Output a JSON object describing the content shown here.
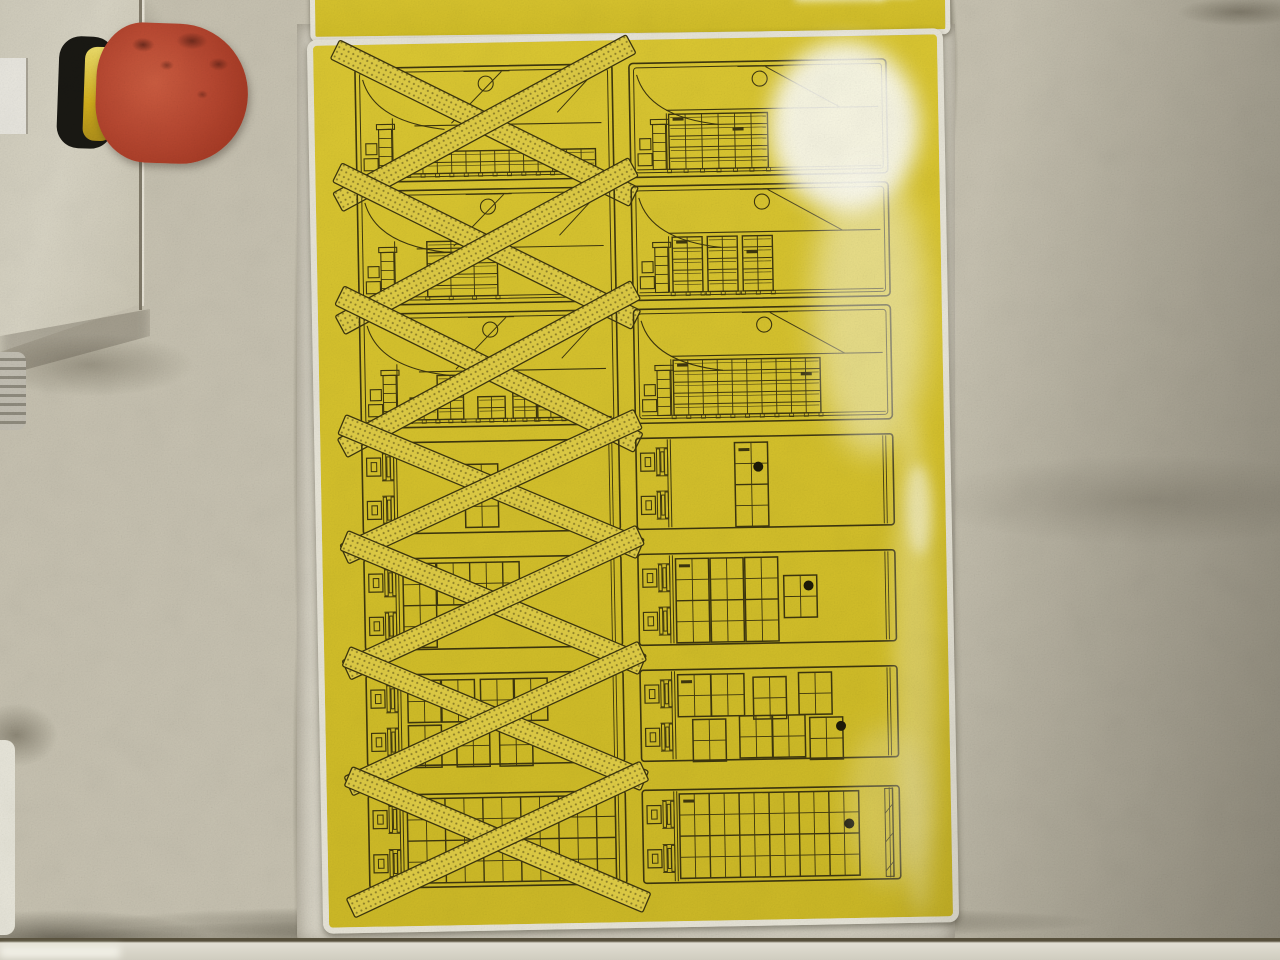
{
  "scene": {
    "description": "Dirty industrial machine panel with a red emergency-stop button and glossy yellow loading-instruction stickers showing prohibited (crossed-out) and correct tray-stack configurations",
    "background_color": "#c7c2b1",
    "plate_color": "#d8d4c6"
  },
  "estop": {
    "name": "emergency-stop-button",
    "head_color": "#b84831",
    "collar_color": "#d2ae1c",
    "base_color": "#191813"
  },
  "top_sticker": {
    "color": "#d6c22e",
    "border_color": "#eae7db"
  },
  "main_sticker": {
    "color": "#d6c22e",
    "border_color": "#e8e5d8",
    "line_color": "#3d360e",
    "cross_band_color": "#e0cd45",
    "rows": [
      {
        "left": {
          "view": "side",
          "crossed": true,
          "stacks": [
            {
              "x": 0.205,
              "w": 0.72,
              "cols": 13,
              "layers": 2
            }
          ],
          "dashes": []
        },
        "right": {
          "view": "side",
          "crossed": false,
          "stacks": [
            {
              "x": 0.155,
              "w": 0.38,
              "cols": 6,
              "layers": 5
            }
          ],
          "dashes": [
            {
              "x": 0.17,
              "layer": 5
            },
            {
              "x": 0.4,
              "layer": 4
            }
          ]
        }
      },
      {
        "left": {
          "view": "side",
          "crossed": true,
          "stacks": [
            {
              "x": 0.27,
              "w": 0.27,
              "cols": 3,
              "layers": 4
            },
            {
              "x": 0.27,
              "w": 0.185,
              "cols": 2,
              "layers": 1,
              "start": 4
            }
          ],
          "dashes": []
        },
        "right": {
          "view": "side",
          "crossed": false,
          "stacks": [
            {
              "x": 0.16,
              "w": 0.115,
              "cols": 2,
              "layers": 5
            },
            {
              "x": 0.295,
              "w": 0.115,
              "cols": 2,
              "layers": 5
            },
            {
              "x": 0.43,
              "w": 0.115,
              "cols": 2,
              "layers": 5
            }
          ],
          "dashes": [
            {
              "x": 0.175,
              "layer": 5
            },
            {
              "x": 0.445,
              "layer": 4
            }
          ]
        }
      },
      {
        "left": {
          "view": "side",
          "crossed": true,
          "stacks": [
            {
              "x": 0.195,
              "w": 0.105,
              "cols": 2,
              "layers": 2
            },
            {
              "x": 0.3,
              "w": 0.1,
              "cols": 2,
              "layers": 4
            },
            {
              "x": 0.455,
              "w": 0.105,
              "cols": 2,
              "layers": 2
            },
            {
              "x": 0.59,
              "w": 0.09,
              "cols": 2,
              "layers": 3
            },
            {
              "x": 0.685,
              "w": 0.1,
              "cols": 2,
              "layers": 2
            }
          ],
          "dashes": []
        },
        "right": {
          "view": "side",
          "crossed": false,
          "stacks": [
            {
              "x": 0.155,
              "w": 0.565,
              "cols": 10,
              "layers": 5
            }
          ],
          "dashes": [
            {
              "x": 0.17,
              "layer": 5
            },
            {
              "x": 0.645,
              "layer": 4
            }
          ]
        }
      },
      {
        "left": {
          "view": "top",
          "crossed": true,
          "groups": [
            {
              "x": 0.4,
              "y": 0.26,
              "cols": 2,
              "rows": 3
            }
          ]
        },
        "right": {
          "view": "top",
          "crossed": false,
          "groups": [
            {
              "x": 0.385,
              "y": 0.08,
              "cols": 2,
              "rows": 4
            }
          ],
          "dash": {
            "x": 0.4,
            "y": 0.14
          },
          "dot": {
            "x": 0.475,
            "y": 0.34
          }
        }
      },
      {
        "left": {
          "view": "top",
          "crossed": true,
          "groups": [
            {
              "x": 0.155,
              "y": 0.07,
              "cols": 2,
              "rows": 4
            },
            {
              "x": 0.285,
              "y": 0.07,
              "cols": 5,
              "rows": 2
            }
          ]
        },
        "right": {
          "view": "top",
          "crossed": false,
          "groups": [
            {
              "x": 0.15,
              "y": 0.07,
              "cols": 2,
              "rows": 4
            },
            {
              "x": 0.283,
              "y": 0.07,
              "cols": 2,
              "rows": 4
            },
            {
              "x": 0.416,
              "y": 0.07,
              "cols": 2,
              "rows": 4
            },
            {
              "x": 0.565,
              "y": 0.27,
              "cols": 2,
              "rows": 2
            }
          ],
          "dash": {
            "x": 0.163,
            "y": 0.13
          },
          "dot": {
            "x": 0.66,
            "y": 0.38
          }
        }
      },
      {
        "left": {
          "view": "top",
          "crossed": true,
          "groups": [
            {
              "x": 0.165,
              "y": 0.08,
              "cols": 2,
              "rows": 2
            },
            {
              "x": 0.295,
              "y": 0.08,
              "cols": 2,
              "rows": 2
            },
            {
              "x": 0.445,
              "y": 0.08,
              "cols": 2,
              "rows": 2
            },
            {
              "x": 0.575,
              "y": 0.08,
              "cols": 2,
              "rows": 2
            },
            {
              "x": 0.165,
              "y": 0.56,
              "cols": 2,
              "rows": 2
            },
            {
              "x": 0.35,
              "y": 0.56,
              "cols": 2,
              "rows": 2
            },
            {
              "x": 0.515,
              "y": 0.56,
              "cols": 2,
              "rows": 2
            }
          ]
        },
        "right": {
          "view": "top",
          "crossed": false,
          "groups": [
            {
              "x": 0.15,
              "y": 0.07,
              "cols": 2,
              "rows": 2
            },
            {
              "x": 0.278,
              "y": 0.07,
              "cols": 2,
              "rows": 2
            },
            {
              "x": 0.44,
              "y": 0.11,
              "cols": 2,
              "rows": 2
            },
            {
              "x": 0.615,
              "y": 0.07,
              "cols": 2,
              "rows": 2
            },
            {
              "x": 0.205,
              "y": 0.55,
              "cols": 2,
              "rows": 2
            },
            {
              "x": 0.385,
              "y": 0.52,
              "cols": 2,
              "rows": 2
            },
            {
              "x": 0.51,
              "y": 0.52,
              "cols": 2,
              "rows": 2
            },
            {
              "x": 0.655,
              "y": 0.55,
              "cols": 2,
              "rows": 2
            }
          ],
          "dash": {
            "x": 0.163,
            "y": 0.13
          },
          "dot": {
            "x": 0.775,
            "y": 0.645
          }
        }
      },
      {
        "left": {
          "view": "top",
          "crossed": true,
          "groups": [
            {
              "x": 0.155,
              "y": 0.06,
              "w": 0.8,
              "h": 0.88,
              "cols": 11,
              "rows": 4
            }
          ]
        },
        "right": {
          "view": "top",
          "crossed": false,
          "groups": [
            {
              "x": 0.148,
              "y": 0.06,
              "w": 0.69,
              "h": 0.88,
              "cols": 12,
              "rows": 4
            }
          ],
          "dash": {
            "x": 0.163,
            "y": 0.12
          },
          "dot": {
            "x": 0.8,
            "y": 0.4
          },
          "rightStrip": true
        }
      }
    ]
  }
}
